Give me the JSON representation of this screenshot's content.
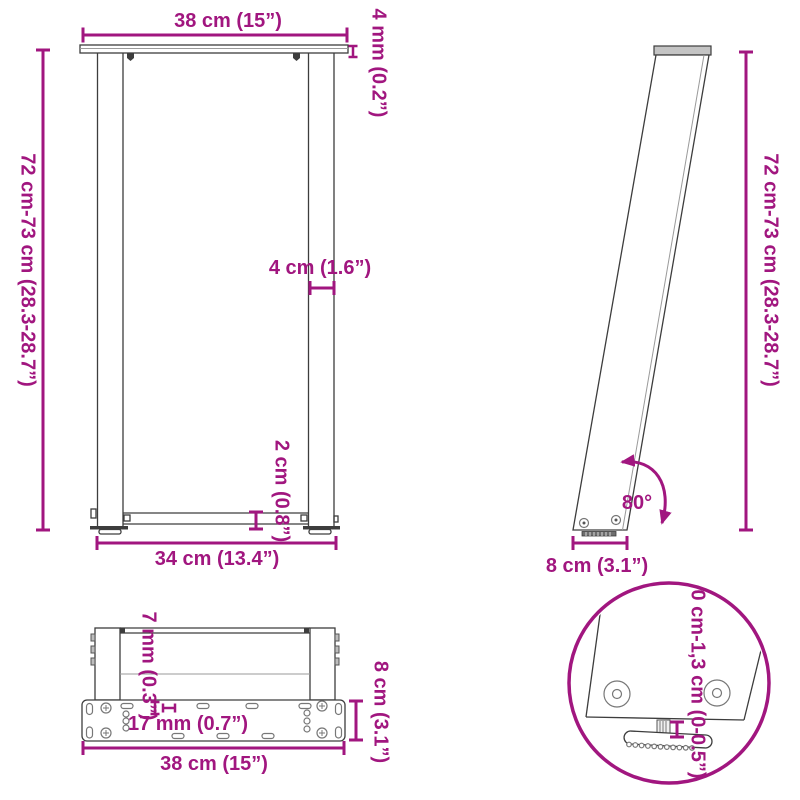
{
  "colors": {
    "dimension": "#a1167f",
    "line": "#3d3d3d"
  },
  "front_view": {
    "top_width": "38 cm (15”)",
    "plate_thickness": "4 mm (0.2”)",
    "height": "72 cm-73 cm (28.3-28.7”)",
    "leg_width": "4 cm (1.6”)",
    "bar_thickness": "2 cm (0.8”)",
    "inner_width": "34 cm (13.4”)"
  },
  "side_view": {
    "height": "72 cm-73 cm (28.3-28.7”)",
    "angle": "80°",
    "base_depth": "8 cm (3.1”)"
  },
  "bottom_view": {
    "plate_edge": "7 mm (0.3”)",
    "hole_spacing": "17 mm (0.7”)",
    "plate_depth": "8 cm (3.1”)",
    "plate_width": "38 cm (15”)"
  },
  "detail_view": {
    "adjustment_range": "0 cm-1,3 cm (0-0.5”)"
  }
}
